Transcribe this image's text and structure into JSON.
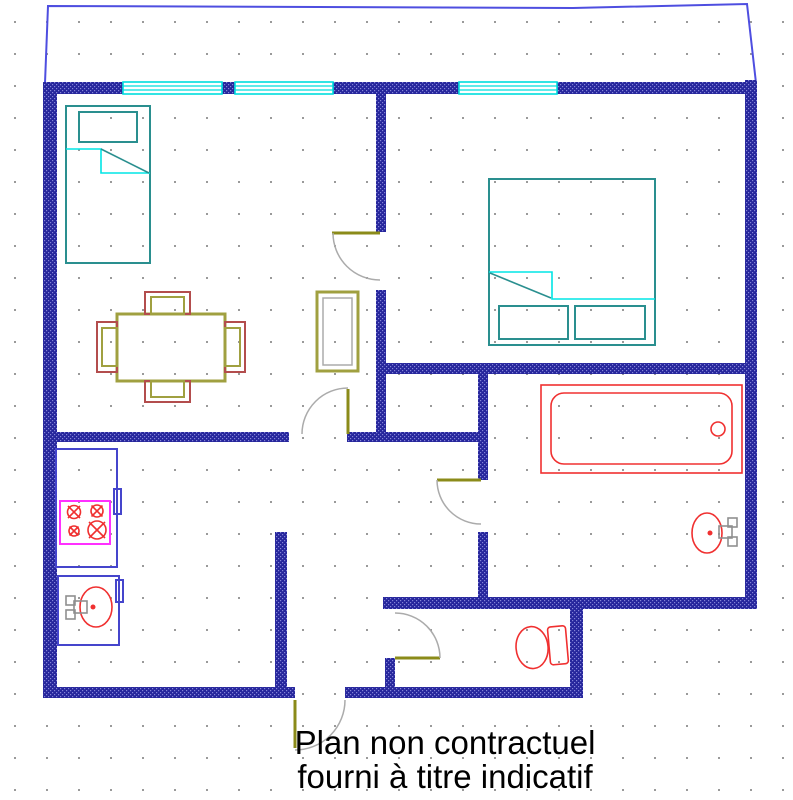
{
  "caption": {
    "line1": "Plan non contractuel",
    "line2": "fourni à titre indicatif"
  },
  "colors": {
    "wall": "#26269c",
    "wall_dot": "#8484d8",
    "window": "#00dede",
    "furniture_teal": "#2a8f8f",
    "fold_cyan": "#00e5e5",
    "table_olive": "#a0a040",
    "chair_red": "#b34d4d",
    "door_panel": "#8b8b1a",
    "door_arc": "#ababab",
    "fixture_red": "#f03030",
    "counter_blue": "#4545cc",
    "stove_magenta": "#ff30ff",
    "faucet_gray": "#8f8f8f",
    "outline_blue": "#4e4ee0",
    "grid_dot": "#9a9a9a",
    "caption_color": "#000000"
  },
  "plan": {
    "type": "apartment-floor-plan",
    "windows_count": 3,
    "doors_count": 5,
    "fixtures": [
      "single-bed",
      "double-bed",
      "dining-table",
      "chair-top",
      "chair-bottom",
      "chair-left",
      "chair-right",
      "closet",
      "kitchen-counter",
      "stove-4-burners",
      "kitchen-sink",
      "bathtub",
      "bathroom-washbasin",
      "toilet"
    ]
  }
}
